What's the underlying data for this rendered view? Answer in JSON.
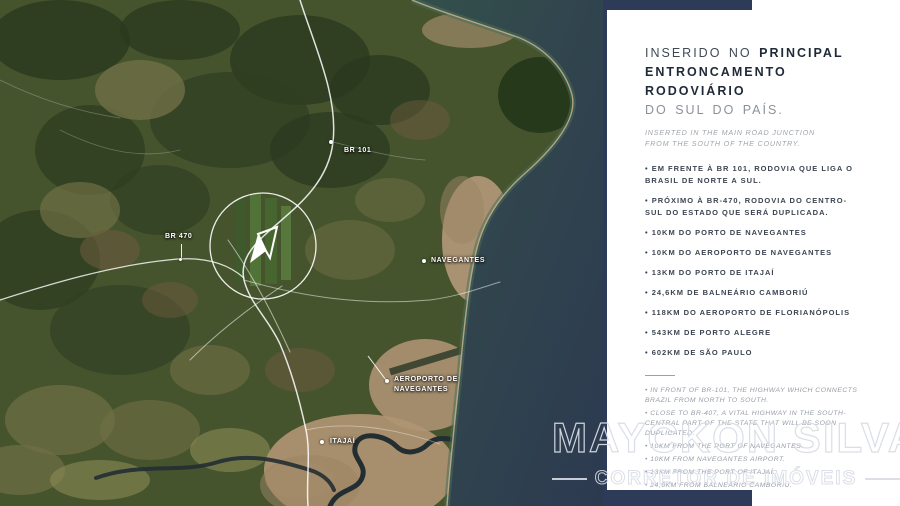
{
  "map": {
    "labels": {
      "br101": "BR 101",
      "br470": "BR 470",
      "navegantes": "NAVEGANTES",
      "aeroporto_line1": "AEROPORTO DE",
      "aeroporto_line2": "NAVEGANTES",
      "itajai": "ITAJAÍ"
    },
    "center_marker": "property-logo-mark"
  },
  "panel": {
    "title": {
      "line1_regular": "INSERIDO NO",
      "line1_bold": "PRINCIPAL",
      "line2_bold": "ENTRONCAMENTO RODOVIÁRIO",
      "line3_muted": "DO SUL DO PAÍS."
    },
    "subtitle": {
      "line1": "INSERTED IN THE MAIN ROAD JUNCTION",
      "line2": "FROM THE SOUTH OF THE COUNTRY."
    },
    "bullets_pt": [
      "EM FRENTE À BR 101, RODOVIA QUE LIGA O BRASIL DE NORTE A SUL.",
      "PRÓXIMO À BR-470, RODOVIA DO CENTRO-SUL DO ESTADO QUE SERÁ DUPLICADA.",
      "10KM DO PORTO DE NAVEGANTES",
      "10KM DO AEROPORTO DE NAVEGANTES",
      "13KM DO PORTO DE ITAJAÍ",
      "24,6KM DE BALNEÁRIO CAMBORIÚ",
      "118KM DO AEROPORTO DE FLORIANÓPOLIS",
      "543KM DE PORTO ALEGRE",
      "602KM DE SÃO PAULO"
    ],
    "bullets_en": [
      "IN FRONT OF BR-101, THE HIGHWAY WHICH CONNECTS BRAZIL FROM NORTH TO SOUTH.",
      "CLOSE TO BR-407, A VITAL HIGHWAY IN THE SOUTH-CENTRAL PART OF THE STATE THAT WILL BE SOON DUPLICATED.",
      "10KM FROM THE PORT OF NAVEGANTES.",
      "10KM FROM NAVEGANTES AIRPORT.",
      "13KM FROM THE PORT OF ITAJAÍ.",
      "24,6KM FROM BALNEÁRIO CAMBORIÚ.",
      "118KM FROM FLORIANÓPOLIS AIRPORT.",
      "543KM FROM PORTO ALEGRE.",
      "602KM FROM SÃO PAULO."
    ]
  },
  "watermark": {
    "name": "MAYCKON SILVA",
    "tagline": "CORRETOR DE IMÓVEIS"
  },
  "colors": {
    "navy_band": "#2d3b58",
    "ocean_deep": "#2c3e52",
    "shore_teal": "#4a6b58",
    "land_green": "#46542e",
    "urban_tan": "#b29878",
    "title_dark": "#1f2937",
    "text_gray": "#969ca5",
    "watermark_outline": "#d8dce5"
  }
}
